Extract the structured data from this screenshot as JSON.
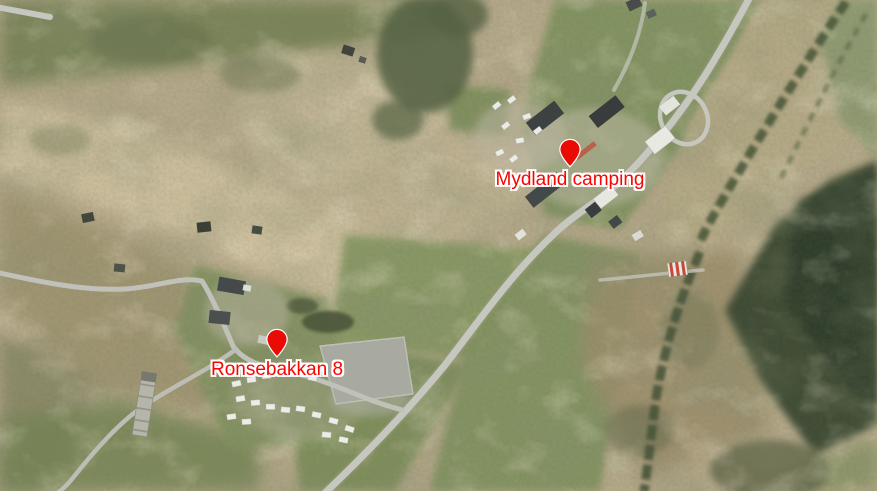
{
  "map": {
    "markers": [
      {
        "id": "mydland-camping",
        "label": "Mydland camping",
        "x": 570,
        "y": 168
      },
      {
        "id": "ronsebakkan-8",
        "label": "Ronsebakkan 8",
        "x": 277,
        "y": 358
      }
    ],
    "colors": {
      "pin_fill": "#e90b04",
      "pin_outline": "#ffffff",
      "label_text": "#fb0300",
      "label_outline": "#ffffff"
    }
  }
}
